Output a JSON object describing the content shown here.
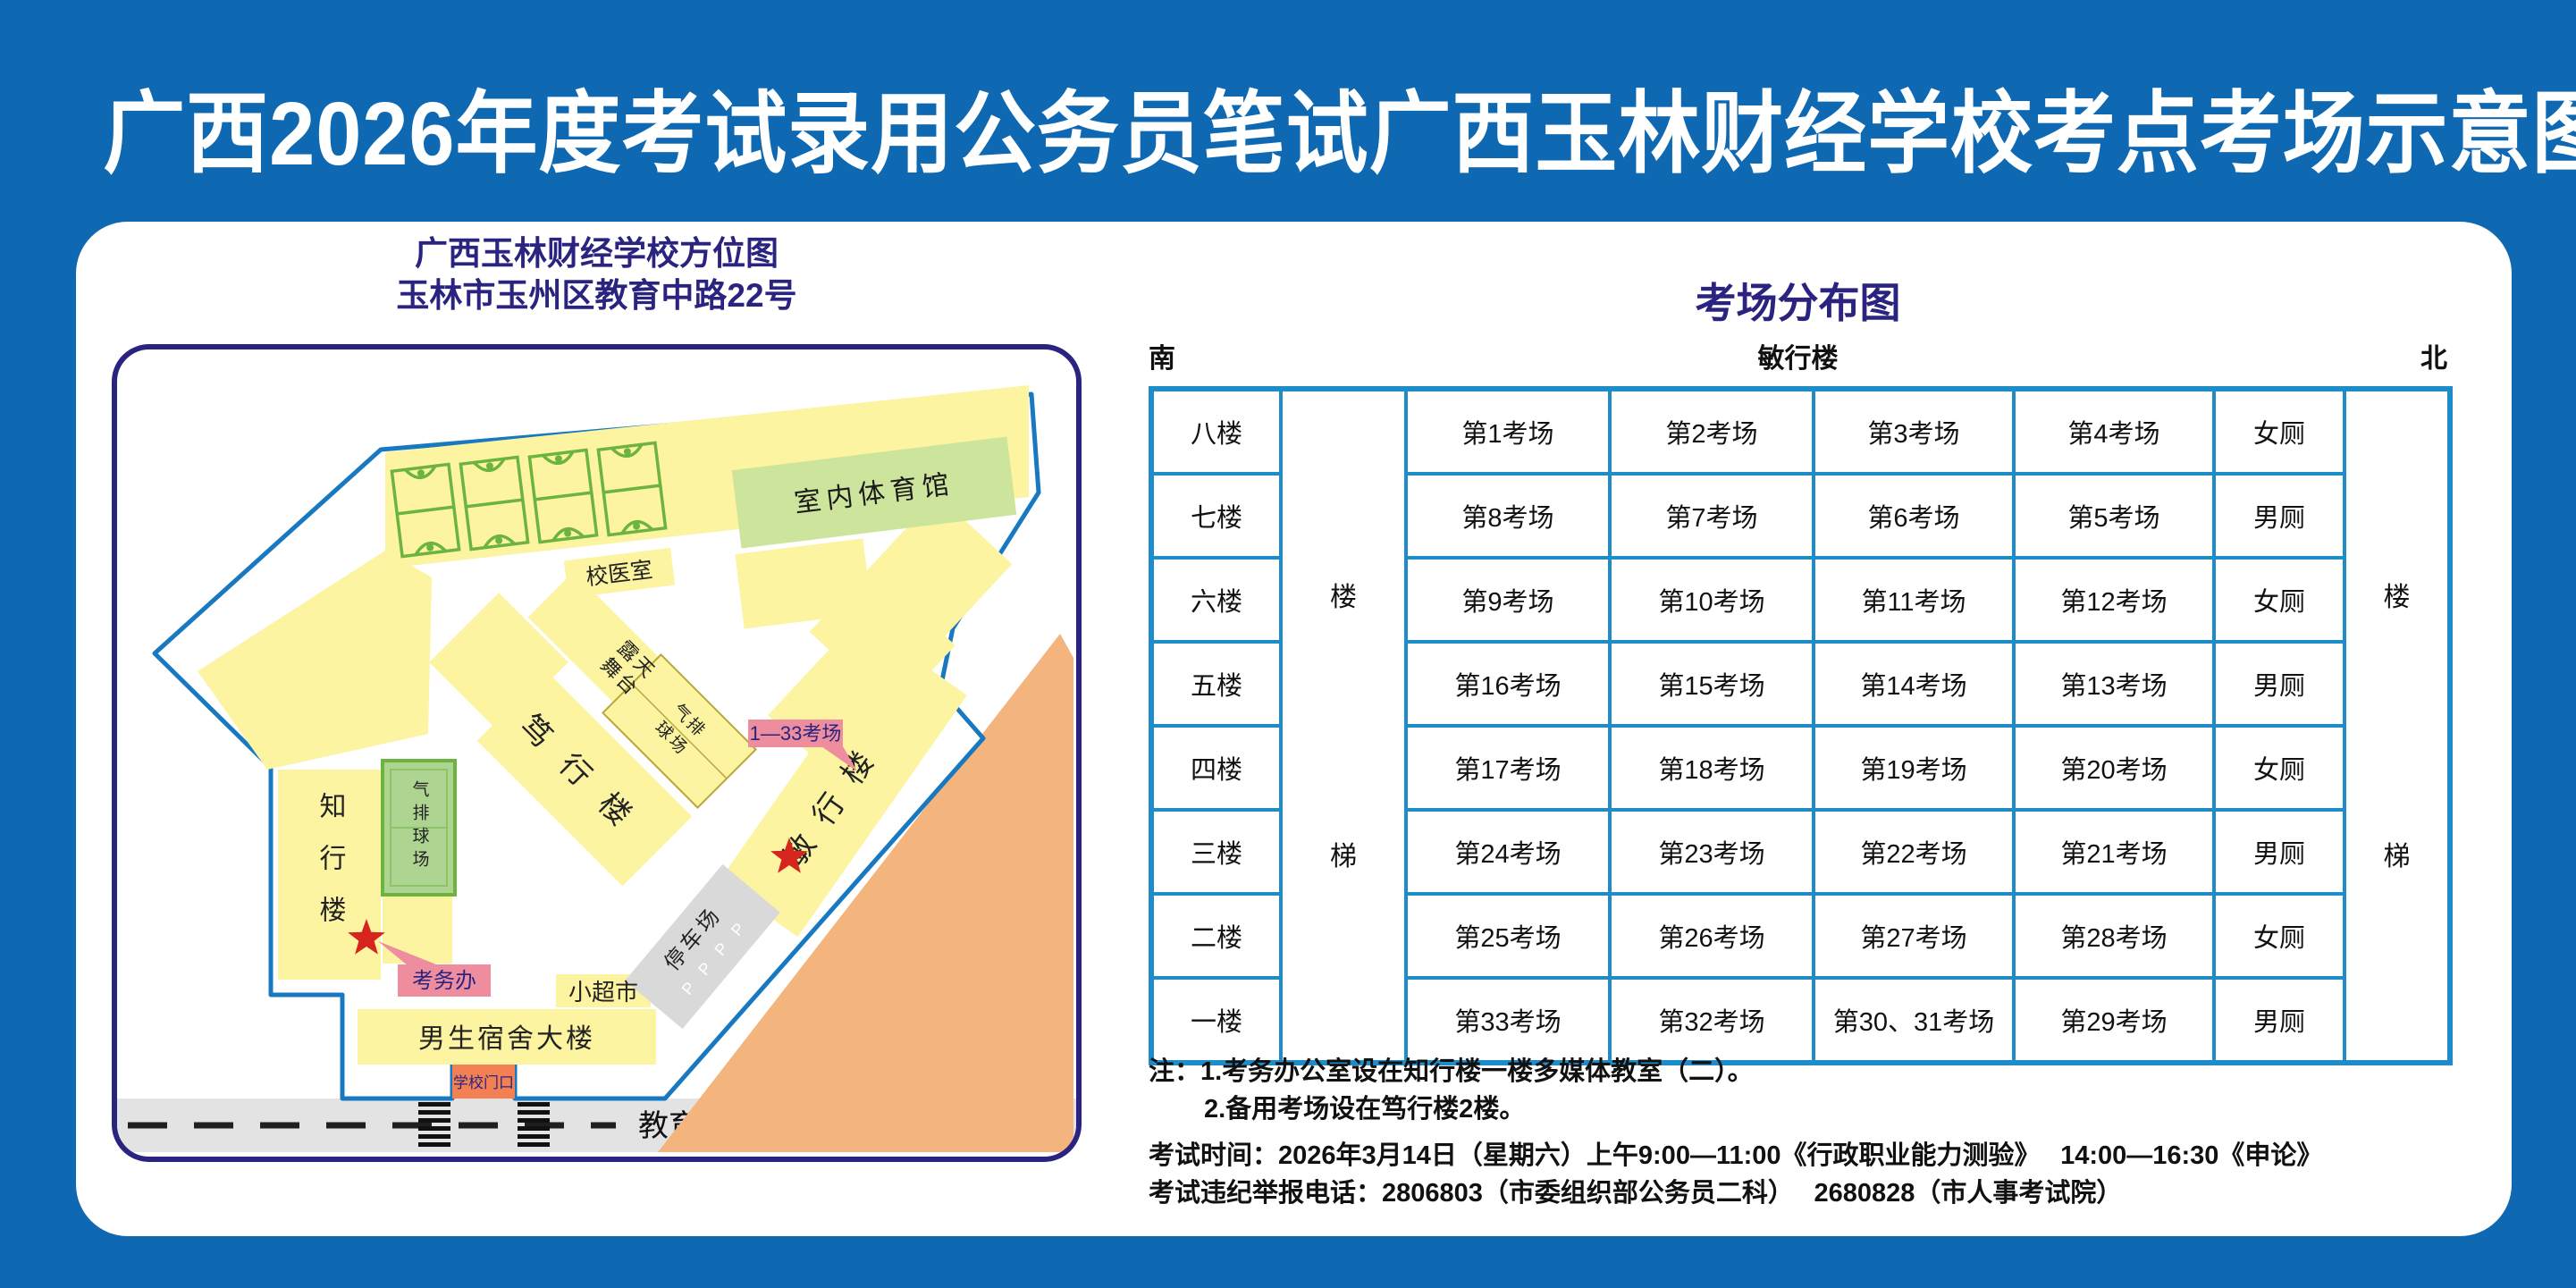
{
  "title": "广西2026年度考试录用公务员笔试广西玉林财经学校考点考场示意图",
  "colors": {
    "background": "#0e68b2",
    "navy": "#2a2480",
    "table_border": "#1f8cca",
    "building_yellow": "#fcf4a0",
    "callout_pink": "#ee8d9d",
    "star_red": "#d6251d",
    "court_green": "#6cb33f",
    "gym_green": "#cde49c",
    "road_gray": "#e3e3e3",
    "outside_orange": "#f4b47d",
    "gate_orange": "#f28053"
  },
  "map": {
    "subtitle1": "广西玉林财经学校方位图",
    "subtitle2": "玉林市玉州区教育中路22号",
    "gym": "室内体育馆",
    "clinic": "校医室",
    "stage1": "露天",
    "stage2": "舞台",
    "duxing": "笃行楼",
    "court_d1": "气排",
    "court_d2": "球场",
    "zhixing": "知行楼",
    "volleyball": "气排球场",
    "callout_rooms": "1—33考场",
    "minxing": "敏行楼",
    "parking": "停车场",
    "parking_p": "P P P P",
    "exam_office": "考务办",
    "supermarket": "小超市",
    "dorm": "男生宿舍大楼",
    "gate": "学校门口",
    "road": "教育中路"
  },
  "distribution": {
    "title": "考场分布图",
    "direction_south": "南",
    "direction_north": "北",
    "building": "敏行楼",
    "stair_top": "楼",
    "stair_bottom": "梯",
    "rows": [
      {
        "floor": "八楼",
        "r1": "第1考场",
        "r2": "第2考场",
        "r3": "第3考场",
        "r4": "第4考场",
        "toilet": "女厕"
      },
      {
        "floor": "七楼",
        "r1": "第8考场",
        "r2": "第7考场",
        "r3": "第6考场",
        "r4": "第5考场",
        "toilet": "男厕"
      },
      {
        "floor": "六楼",
        "r1": "第9考场",
        "r2": "第10考场",
        "r3": "第11考场",
        "r4": "第12考场",
        "toilet": "女厕"
      },
      {
        "floor": "五楼",
        "r1": "第16考场",
        "r2": "第15考场",
        "r3": "第14考场",
        "r4": "第13考场",
        "toilet": "男厕"
      },
      {
        "floor": "四楼",
        "r1": "第17考场",
        "r2": "第18考场",
        "r3": "第19考场",
        "r4": "第20考场",
        "toilet": "女厕"
      },
      {
        "floor": "三楼",
        "r1": "第24考场",
        "r2": "第23考场",
        "r3": "第22考场",
        "r4": "第21考场",
        "toilet": "男厕"
      },
      {
        "floor": "二楼",
        "r1": "第25考场",
        "r2": "第26考场",
        "r3": "第27考场",
        "r4": "第28考场",
        "toilet": "女厕"
      },
      {
        "floor": "一楼",
        "r1": "第33考场",
        "r2": "第32考场",
        "r3": "第30、31考场",
        "r4": "第29考场",
        "toilet": "男厕"
      }
    ]
  },
  "notes": {
    "line1": "注：1.考务办公室设在知行楼一楼多媒体教室（二）。",
    "line2": "2.备用考场设在笃行楼2楼。",
    "exam_time": "考试时间：2026年3月14日（星期六）上午9:00—11:00《行政职业能力测验》　 14:00—16:30《申论》",
    "hotline": "考试违纪举报电话：2806803（市委组织部公务员二科）　 2680828（市人事考试院）"
  }
}
